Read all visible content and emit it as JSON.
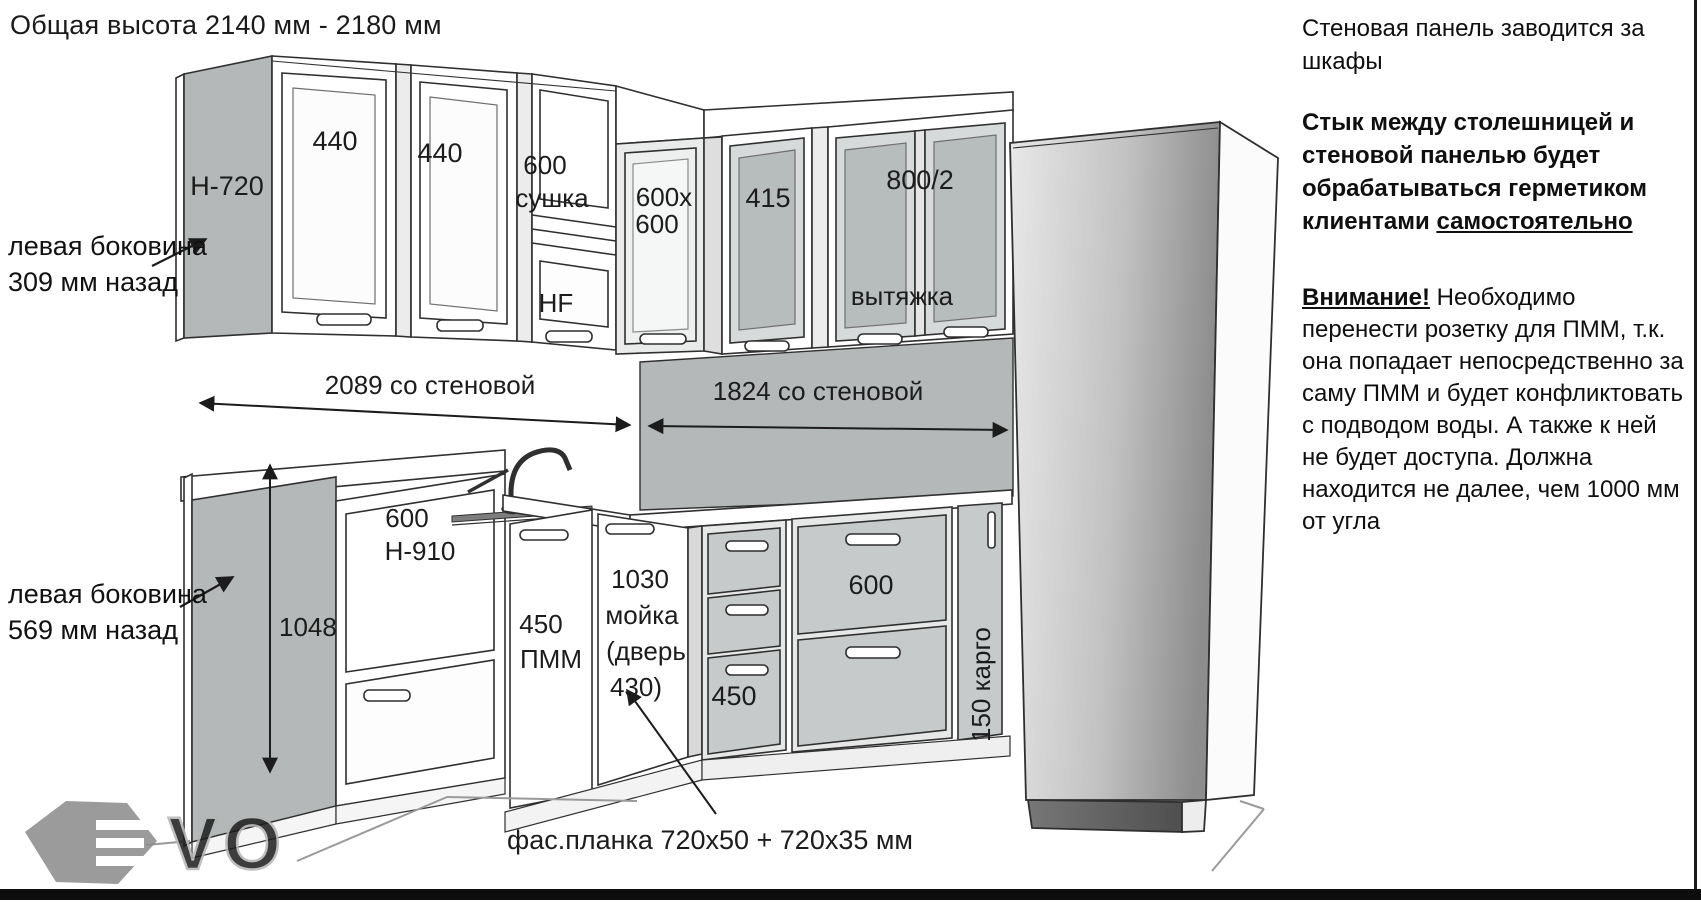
{
  "title": "Общая высота 2140 мм - 2180 мм",
  "upper": {
    "side_panel": "Н-720",
    "cab1": "440",
    "cab2": "440",
    "dryer_size": "600",
    "dryer_name": "сушка",
    "dryer_door": "HF",
    "corner1": "600х",
    "corner2": "600",
    "cab415": "415",
    "hood_cab": "800/2",
    "hood": "вытяжка"
  },
  "dims": {
    "left_run": "2089 со стеновой",
    "right_run": "1824 со стеновой",
    "side_height": "1048"
  },
  "base": {
    "tall_size": "600",
    "tall_h": "Н-910",
    "dw_size": "450",
    "dw_name": "ПММ",
    "sink1": "1030",
    "sink2": "мойка",
    "sink3": "(дверь",
    "sink4": "430)",
    "drw450": "450",
    "drw600": "600",
    "cargo": "150 карго"
  },
  "callouts": {
    "top1": "левая боковина",
    "top2": "309 мм назад",
    "bottom1": "левая боковина",
    "bottom2": "569 мм назад",
    "facade": "фас.планка 720х50 + 720х35 мм"
  },
  "notes": {
    "n1": "Стеновая панель заводится за шкафы",
    "n2": "Стык между столешницей и стеновой панелью будет обрабатываться герметиком клиентами ",
    "n2u": "самостоятельно",
    "n3t": "Внимание!",
    "n3": " Необходимо перенести розетку для ПММ, т.к. она попадает непосредственно за саму ПММ и будет конфликтовать с подводом воды. А также к ней не будет доступа. Должна находится не далее, чем 1000 мм от угла"
  },
  "logo": {
    "vo": "VO"
  },
  "colors": {
    "line": "#2f2f2f",
    "panel_gray": "#b4b8b8",
    "drawer_gray": "#c6caca",
    "bottom_bar": "#0d0d0d"
  }
}
